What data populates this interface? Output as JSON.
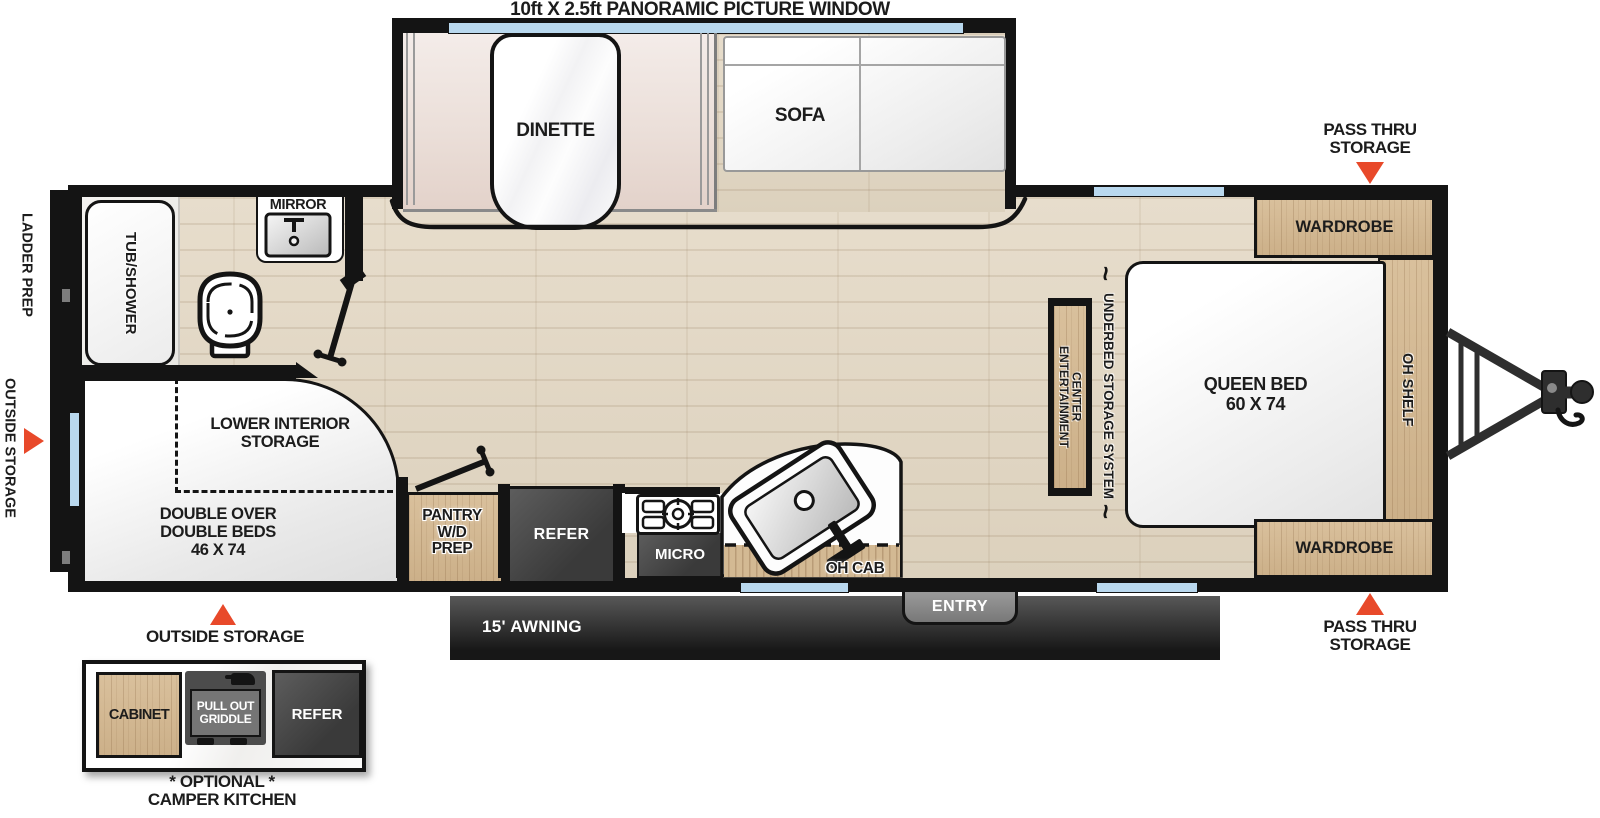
{
  "title": "10ft X 2.5ft PANORAMIC PICTURE WINDOW",
  "colors": {
    "accent_red": "#E8492A",
    "window_blue": "#B9D8EE",
    "wall_black": "#141414",
    "wood_tan": "#D3B993",
    "floor_beige": "#E2D8C6",
    "appliance_dark": "#474747",
    "awning_dark": "#2B2B2B"
  },
  "icons": {
    "squiggle": "~"
  },
  "labels": {
    "dinette": "DINETTE",
    "sofa": "SOFA",
    "wardrobe_top": "WARDROBE",
    "wardrobe_bottom": "WARDROBE",
    "oh_shelf": "OH SHELF",
    "queen_bed": "QUEEN BED\n60 X 74",
    "entertainment_center": "ENTERTAINMENT\nCENTER",
    "underbed_storage": "UNDERBED STORAGE SYSTEM",
    "pass_thru_top": "PASS THRU\nSTORAGE",
    "pass_thru_bottom": "PASS THRU\nSTORAGE",
    "ladder_prep": "LADDER PREP",
    "outside_storage_left": "OUTSIDE STORAGE",
    "outside_storage_bottom": "OUTSIDE STORAGE",
    "tub_shower": "TUB/SHOWER",
    "mirror": "MIRROR",
    "lower_interior_storage": "LOWER INTERIOR\nSTORAGE",
    "double_beds": "DOUBLE OVER\nDOUBLE BEDS\n46 X 74",
    "pantry": "PANTRY\nW/D\nPREP",
    "refer": "REFER",
    "micro": "MICRO",
    "oh_cab": "OH CAB",
    "entry": "ENTRY",
    "awning": "15' AWNING",
    "camper_cabinet": "CABINET",
    "camper_griddle": "PULL OUT\nGRIDDLE",
    "camper_refer": "REFER",
    "camper_optional": "* OPTIONAL *",
    "camper_name": "CAMPER KITCHEN"
  }
}
